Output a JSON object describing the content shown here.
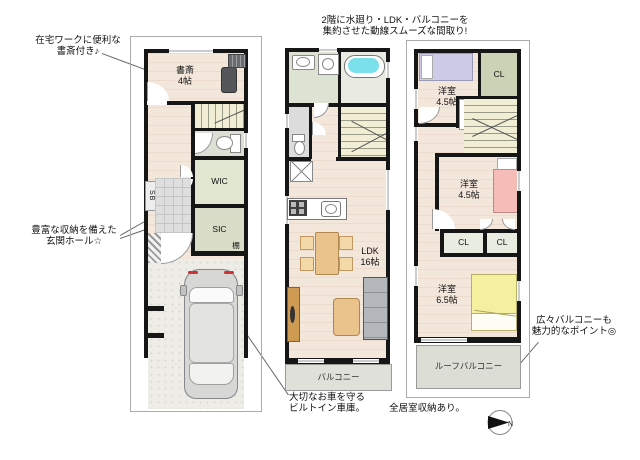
{
  "annotations": {
    "study_note": "在宅ワークに便利な\n書斎付き♪",
    "flow_note": "2階に水廻り・LDK・バルコニーを\n集約させた動線スムーズな間取り!",
    "storage_note": "豊富な収納を備えた\n玄関ホール☆",
    "garage_note": "大切なお車を守る\nビルトイン車庫。",
    "all_rooms_note": "全居室収納あり。",
    "balcony_note": "広々バルコニーも\n魅力的なポイント◎",
    "compass_n": "N"
  },
  "floor1": {
    "study_label": "書斎\n4帖",
    "wic_label": "WIC",
    "sic_label": "SIC",
    "shoebox_label": "SB",
    "shelf_label": "棚"
  },
  "floor2": {
    "ldk_label": "LDK\n16帖",
    "balcony_label": "バルコニー"
  },
  "floor3": {
    "bedroom1_label": "洋室\n4.5帖",
    "closet1_label": "CL",
    "shelf_label": "棚",
    "bedroom2_label": "洋室\n4.5帖",
    "closet2_label": "CL",
    "closet3_label": "CL",
    "bedroom3_label": "洋室\n6.5帖",
    "roof_balcony_label": "ルーフバルコニー"
  },
  "colors": {
    "wall": "#161616",
    "wood_floor": "#f3e6db",
    "bathtub": "#7ce0ea",
    "closet_green": "#ccd2b6",
    "bed_lavender": "#cecbe8",
    "bed_pink": "#f5bcb8",
    "bed_yellow": "#f5efa0",
    "balcony_gray": "#e0e0da"
  }
}
